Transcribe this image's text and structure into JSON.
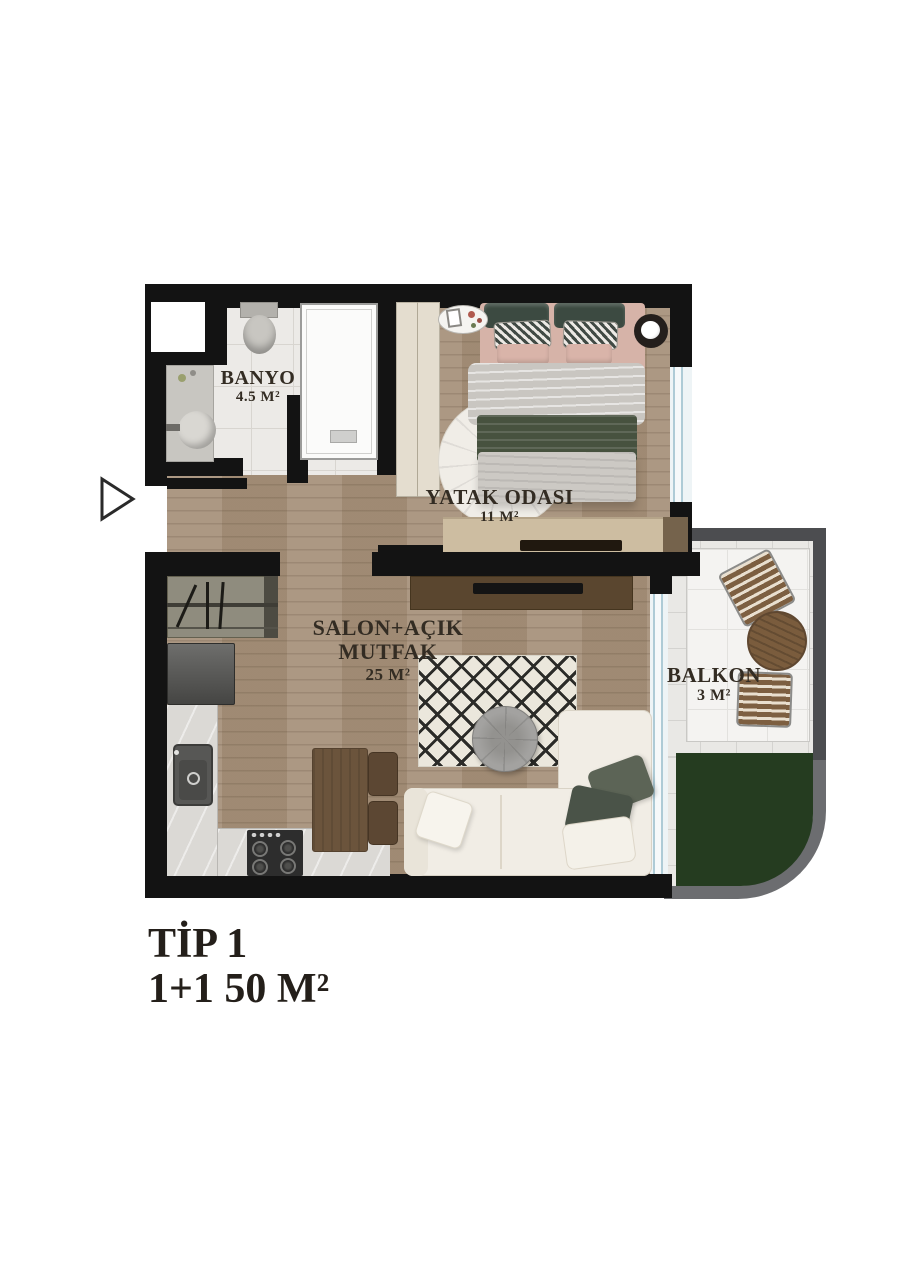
{
  "plan": {
    "title": "TİP 1",
    "subtitle": "1+1 50 M²",
    "rooms": [
      {
        "name": "BANYO",
        "area": "4.5 M²"
      },
      {
        "name": "YATAK ODASI",
        "area": "11 M²"
      },
      {
        "name": "SALON+AÇIK MUTFAK",
        "area": "25 M²"
      },
      {
        "name": "BALKON",
        "area": "3 M²"
      }
    ],
    "colors": {
      "wall": "#131313",
      "wood_floor": "#a7927b",
      "bathroom_tile": "#eceae7",
      "balcony_wall": "#66676b",
      "greenery": "#253c20",
      "label_text": "#332c23"
    }
  }
}
